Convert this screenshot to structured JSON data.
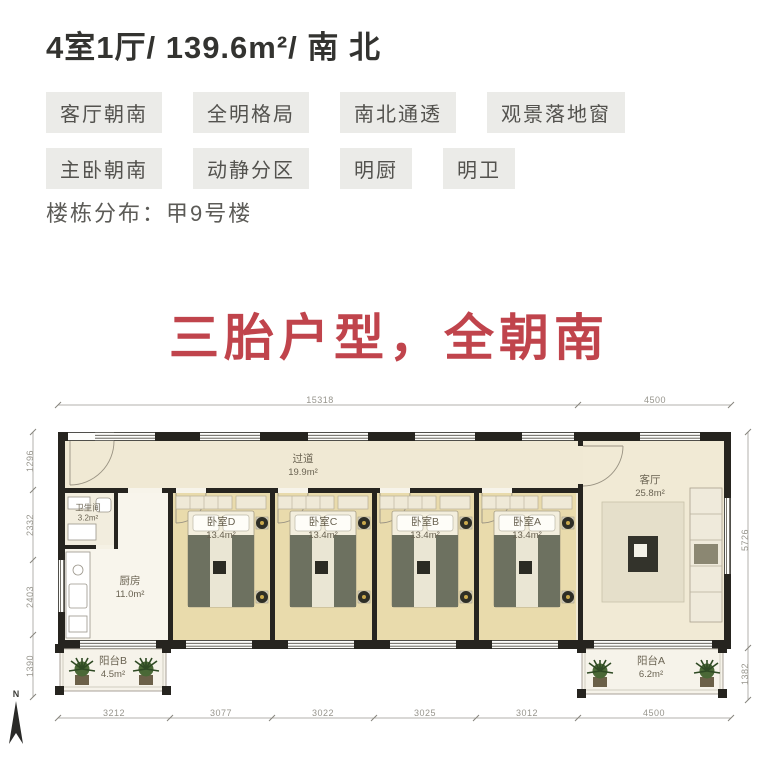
{
  "header": {
    "title": "4室1厅/ 139.6m²/ 南 北",
    "tags_row1": [
      "客厅朝南",
      "全明格局",
      "南北通透",
      "观景落地窗"
    ],
    "tags_row2": [
      "主卧朝南",
      "动静分区",
      "明厨",
      "明卫"
    ],
    "building_label": "楼栋分布：甲9号楼"
  },
  "slogan": "三胎户型，全朝南",
  "floorplan": {
    "north_label": "N",
    "rooms": {
      "corridor": {
        "name": "过道",
        "area": "19.9m²"
      },
      "living": {
        "name": "客厅",
        "area": "25.8m²"
      },
      "bathroom": {
        "name": "卫生间",
        "area": "3.2m²"
      },
      "kitchen": {
        "name": "厨房",
        "area": "11.0m²"
      },
      "bedroom_d": {
        "name": "卧室D",
        "area": "13.4m²"
      },
      "bedroom_c": {
        "name": "卧室C",
        "area": "13.4m²"
      },
      "bedroom_b": {
        "name": "卧室B",
        "area": "13.4m²"
      },
      "bedroom_a": {
        "name": "卧室A",
        "area": "13.4m²"
      },
      "balcony_b": {
        "name": "阳台B",
        "area": "4.5m²"
      },
      "balcony_a": {
        "name": "阳台A",
        "area": "6.2m²"
      }
    },
    "dimensions": {
      "top": [
        "15318",
        "4500"
      ],
      "bottom": [
        "3212",
        "3077",
        "3022",
        "3025",
        "3012",
        "4500"
      ],
      "left": [
        "1296",
        "2332",
        "2403",
        "1390"
      ],
      "right": [
        "5726",
        "1382"
      ]
    }
  },
  "colors": {
    "slogan_red": "#c0444c",
    "tag_bg": "#ebebe8",
    "bedroom_floor": "#e9dbac",
    "hall_floor": "#f1ead5",
    "wall": "#26241f"
  }
}
